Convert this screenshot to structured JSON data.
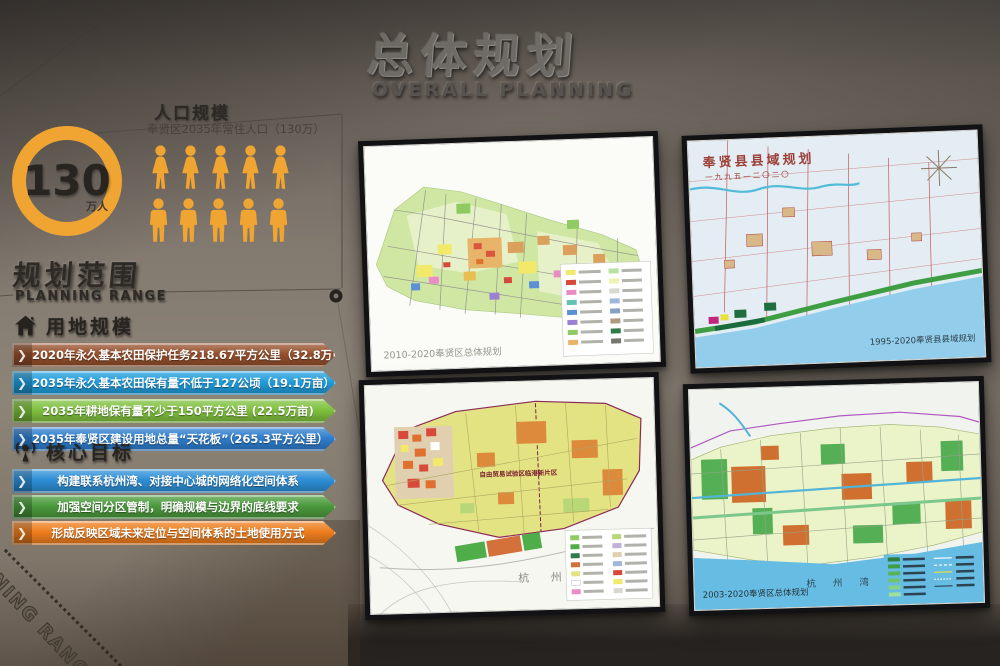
{
  "wall": {
    "title_cn": "总体规划",
    "title_en": "OVERALL PLANNING",
    "corner_text": "NING RANGE"
  },
  "population": {
    "heading": "人口规模",
    "subheading": "奉贤区2035年常住人口（130万）",
    "circle_value": "130",
    "circle_unit": "万人",
    "female_icons": 5,
    "male_icons": 5,
    "accent_color": "#F0A432"
  },
  "planning_range": {
    "heading_cn": "规划范围",
    "heading_en": "PLANNING RANGE"
  },
  "land_use": {
    "heading": "用地规模",
    "items": [
      {
        "text": "2020年永久基本农田保护任务218.67平方公里（32.8万亩）",
        "color": "#96502c"
      },
      {
        "text": "2035年永久基本农田保有量不低于127公顷（19.1万亩）",
        "color": "#1f9ddc"
      },
      {
        "text": "2035年耕地保有量不少于150平方公里 (22.5万亩)",
        "color": "#7fc13e"
      },
      {
        "text": "2035年奉贤区建设用地总量“天花板”（265.3平方公里）",
        "color": "#2e7ecf"
      }
    ]
  },
  "core_goals": {
    "heading": "核心目标",
    "items": [
      {
        "text": "构建联系杭州湾、对接中心城的网络化空间体系",
        "color": "#2e8fd7"
      },
      {
        "text": "加强空间分区管制，明确规模与边界的底线要求",
        "color": "#4b9a3c"
      },
      {
        "text": "形成反映区域未来定位与空间体系的土地使用方式",
        "color": "#ee7d1d"
      }
    ]
  },
  "maps": {
    "top_left": {
      "caption": "2010-2020奉贤区总体规划"
    },
    "top_right": {
      "title": "奉贤县县域规划",
      "subtitle": "一九九五—二〇二〇",
      "caption": "1995-2020奉贤县县域规划"
    },
    "bottom_left": {
      "area_label": "自由贸易试验区临港新片区",
      "sea_label": "杭 州 湾"
    },
    "bottom_right": {
      "sea_label": "杭 州 湾",
      "caption": "2003-2020奉贤区总体规划"
    }
  }
}
